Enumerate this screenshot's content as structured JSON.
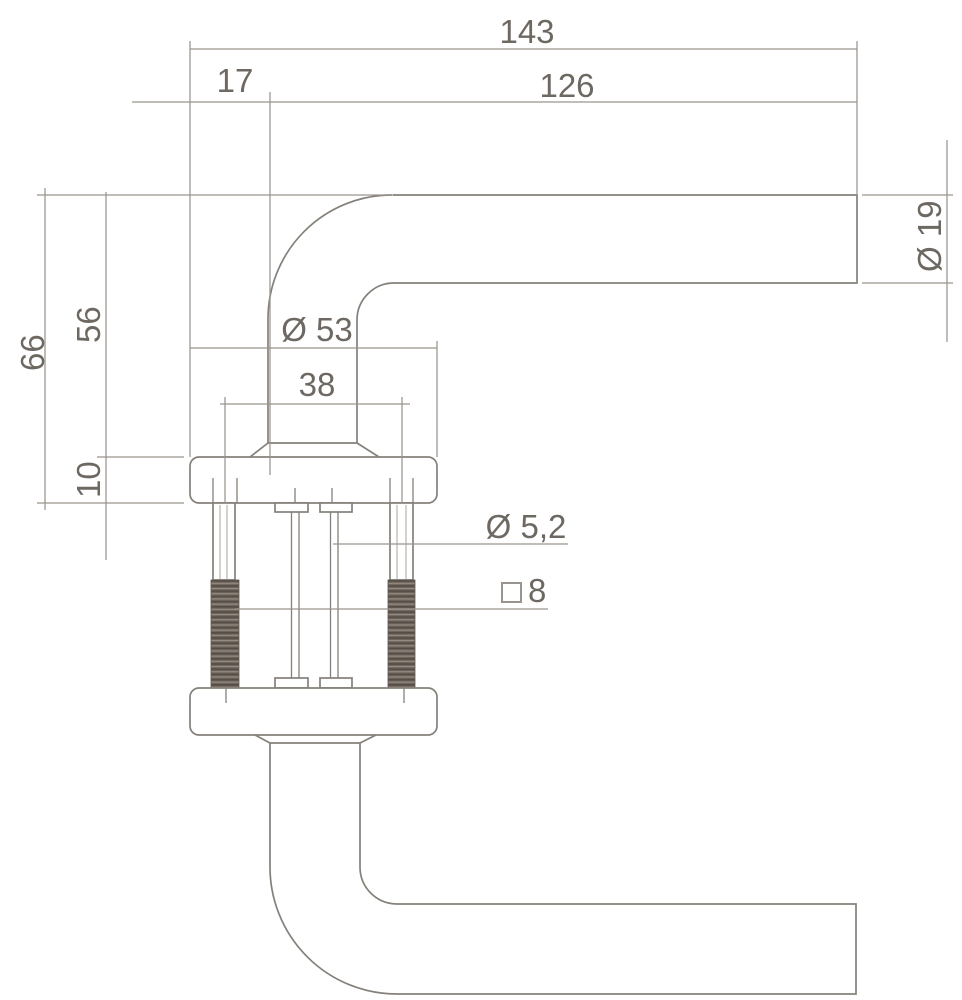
{
  "drawing": {
    "labels": {
      "total_width": "143",
      "neck_offset": "17",
      "grip_length": "126",
      "tube_diameter": "Ø 19",
      "total_height": "66",
      "height_to_rose_top": "56",
      "rose_thickness": "10",
      "rose_diameter": "Ø 53",
      "screw_spacing": "38",
      "screw_diameter": "Ø 5,2",
      "spindle_square_size": "8"
    },
    "colors": {
      "background": "#ffffff",
      "outline": "#85807a",
      "dimension_line": "#9a948e",
      "text": "#6e6862",
      "thread_base": "#6f665d",
      "thread_dark": "#564e46",
      "thread_light": "#958c83"
    }
  }
}
